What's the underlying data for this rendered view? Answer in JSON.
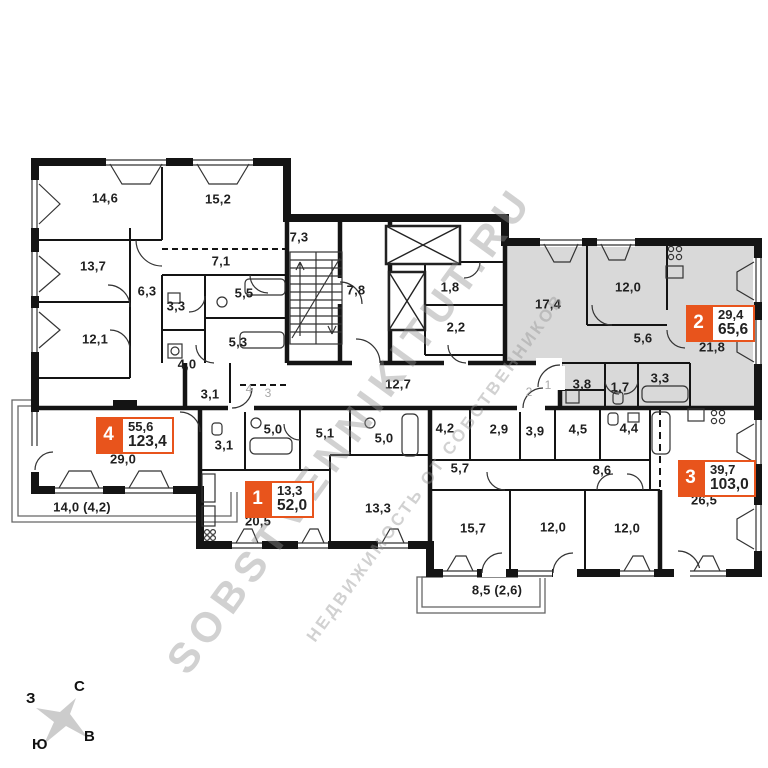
{
  "colors": {
    "badge_orange": "#e8541c",
    "apartment2_fill": "#d9d9d9",
    "walls": "#141414",
    "watermark_gray": "#919191",
    "compass_star": "#cccccc"
  },
  "watermark": {
    "line1": "SOBSTVENNIKITUT.RU",
    "line2": "НЕДВИЖИМОСТЬ ОТ СОБСТВЕННИКОВ"
  },
  "compass": {
    "north": "С",
    "south": "Ю",
    "west": "З",
    "east": "В"
  },
  "apartments": [
    {
      "number": "1",
      "living_area": "13,3",
      "total_area": "52,0"
    },
    {
      "number": "2",
      "living_area": "29,4",
      "total_area": "65,6"
    },
    {
      "number": "3",
      "living_area": "39,7",
      "total_area": "103,0"
    },
    {
      "number": "4",
      "living_area": "55,6",
      "total_area": "123,4"
    }
  ],
  "rooms": [
    {
      "apartment": "4",
      "label": "14,6",
      "x": 105,
      "y": 198
    },
    {
      "apartment": "4",
      "label": "15,2",
      "x": 218,
      "y": 199
    },
    {
      "apartment": "4",
      "label": "13,7",
      "x": 93,
      "y": 266
    },
    {
      "apartment": "4",
      "label": "7,1",
      "x": 221,
      "y": 261
    },
    {
      "apartment": "4",
      "label": "6,3",
      "x": 147,
      "y": 291
    },
    {
      "apartment": "4",
      "label": "3,3",
      "x": 176,
      "y": 306
    },
    {
      "apartment": "4",
      "label": "5,5",
      "x": 244,
      "y": 293
    },
    {
      "apartment": "4",
      "label": "12,1",
      "x": 95,
      "y": 339
    },
    {
      "apartment": "4",
      "label": "5,3",
      "x": 238,
      "y": 342
    },
    {
      "apartment": "4",
      "label": "4,0",
      "x": 187,
      "y": 364
    },
    {
      "apartment": "4",
      "label": "3,1",
      "x": 210,
      "y": 394
    },
    {
      "apartment": "4",
      "label": "29,0",
      "x": 123,
      "y": 459
    },
    {
      "apartment": "core",
      "label": "7,3",
      "x": 299,
      "y": 237
    },
    {
      "apartment": "core",
      "label": "7,8",
      "x": 356,
      "y": 290
    },
    {
      "apartment": "core",
      "label": "1,8",
      "x": 450,
      "y": 287
    },
    {
      "apartment": "core",
      "label": "2,2",
      "x": 456,
      "y": 327
    },
    {
      "apartment": "core",
      "label": "12,7",
      "x": 398,
      "y": 384
    },
    {
      "apartment": "2",
      "label": "17,4",
      "x": 548,
      "y": 304
    },
    {
      "apartment": "2",
      "label": "12,0",
      "x": 628,
      "y": 287
    },
    {
      "apartment": "2",
      "label": "5,6",
      "x": 643,
      "y": 338
    },
    {
      "apartment": "2",
      "label": "21,8",
      "x": 712,
      "y": 347
    },
    {
      "apartment": "2",
      "label": "3,8",
      "x": 582,
      "y": 384
    },
    {
      "apartment": "2",
      "label": "1,7",
      "x": 620,
      "y": 387
    },
    {
      "apartment": "2",
      "label": "3,3",
      "x": 660,
      "y": 378
    },
    {
      "apartment": "1",
      "label": "3,1",
      "x": 224,
      "y": 445
    },
    {
      "apartment": "1",
      "label": "5,0",
      "x": 273,
      "y": 429
    },
    {
      "apartment": "1",
      "label": "5,1",
      "x": 325,
      "y": 433
    },
    {
      "apartment": "1",
      "label": "5,0",
      "x": 384,
      "y": 438
    },
    {
      "apartment": "1",
      "label": "13,3",
      "x": 378,
      "y": 508
    },
    {
      "apartment": "1",
      "label": "20,5",
      "x": 258,
      "y": 521
    },
    {
      "apartment": "3",
      "label": "4,2",
      "x": 445,
      "y": 428
    },
    {
      "apartment": "3",
      "label": "2,9",
      "x": 499,
      "y": 429
    },
    {
      "apartment": "3",
      "label": "3,9",
      "x": 535,
      "y": 431
    },
    {
      "apartment": "3",
      "label": "4,5",
      "x": 578,
      "y": 429
    },
    {
      "apartment": "3",
      "label": "4,4",
      "x": 629,
      "y": 428
    },
    {
      "apartment": "3",
      "label": "5,7",
      "x": 460,
      "y": 468
    },
    {
      "apartment": "3",
      "label": "8,6",
      "x": 602,
      "y": 470
    },
    {
      "apartment": "3",
      "label": "15,7",
      "x": 473,
      "y": 528
    },
    {
      "apartment": "3",
      "label": "12,0",
      "x": 553,
      "y": 527
    },
    {
      "apartment": "3",
      "label": "12,0",
      "x": 627,
      "y": 528
    },
    {
      "apartment": "3",
      "label": "26,5",
      "x": 704,
      "y": 500
    }
  ],
  "balconies": [
    {
      "label": "14,0 (4,2)",
      "x": 82,
      "y": 507
    },
    {
      "label": "8,5 (2,6)",
      "x": 497,
      "y": 590
    }
  ],
  "door_numbers": [
    {
      "label": "4",
      "x": 249,
      "y": 389
    },
    {
      "label": "3",
      "x": 268,
      "y": 393
    },
    {
      "label": "2",
      "x": 529,
      "y": 392
    },
    {
      "label": "1",
      "x": 548,
      "y": 385
    }
  ]
}
